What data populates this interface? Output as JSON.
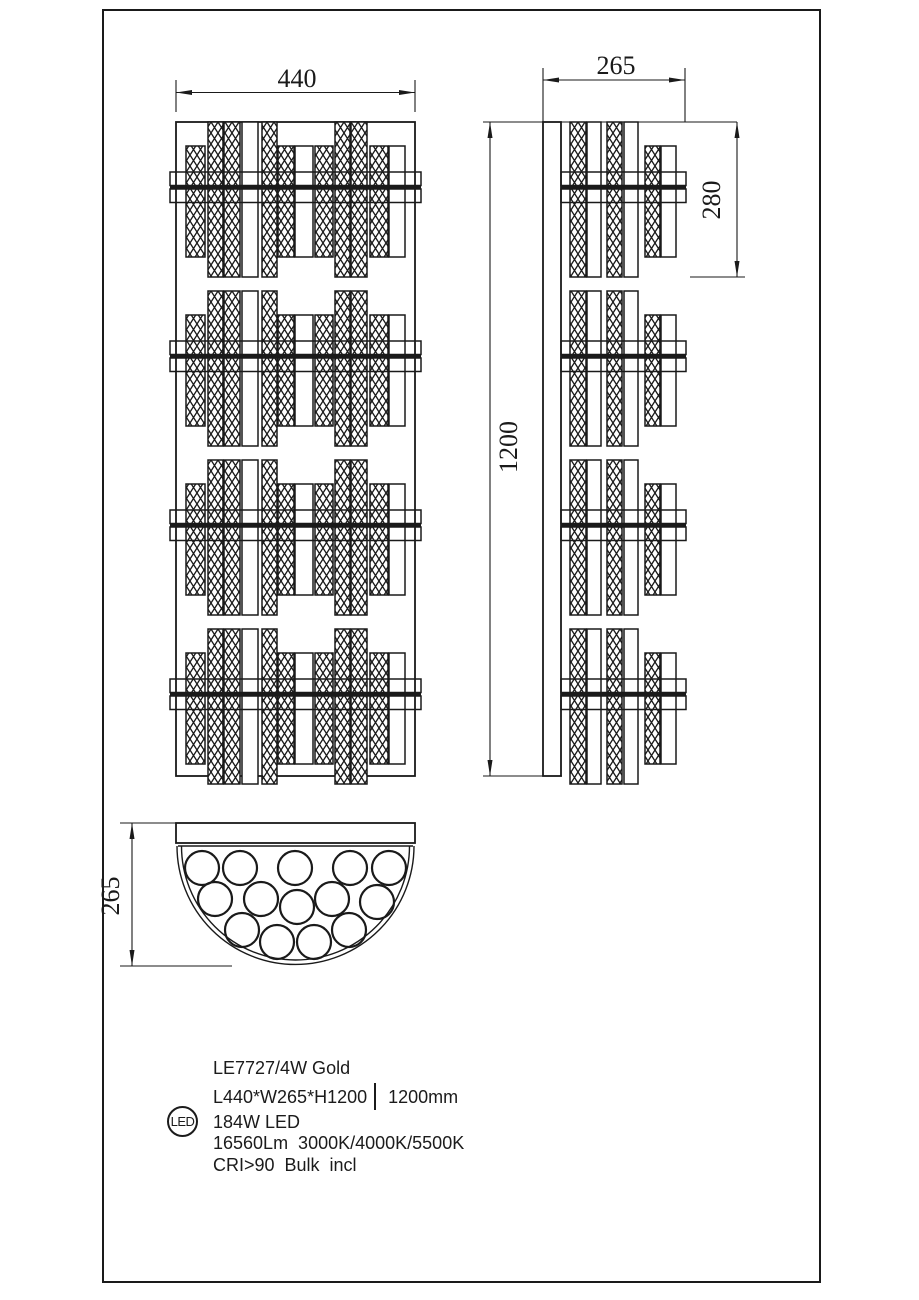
{
  "sheet": {
    "background": "#ffffff",
    "line_color": "#1a1a1a"
  },
  "dimensions": {
    "front_width": "440",
    "side_depth": "265",
    "fixture_height": "1200",
    "cluster_height": "280",
    "top_view_depth": "265"
  },
  "specs": {
    "model": "LE7727/4W Gold",
    "size": "L440*W265*H1200",
    "height_note": "1200mm",
    "wattage": "184W LED",
    "output": "16560Lm  3000K/4000K/5500K",
    "cri": "CRI>90  Bulk  incl",
    "badge": "LED"
  }
}
